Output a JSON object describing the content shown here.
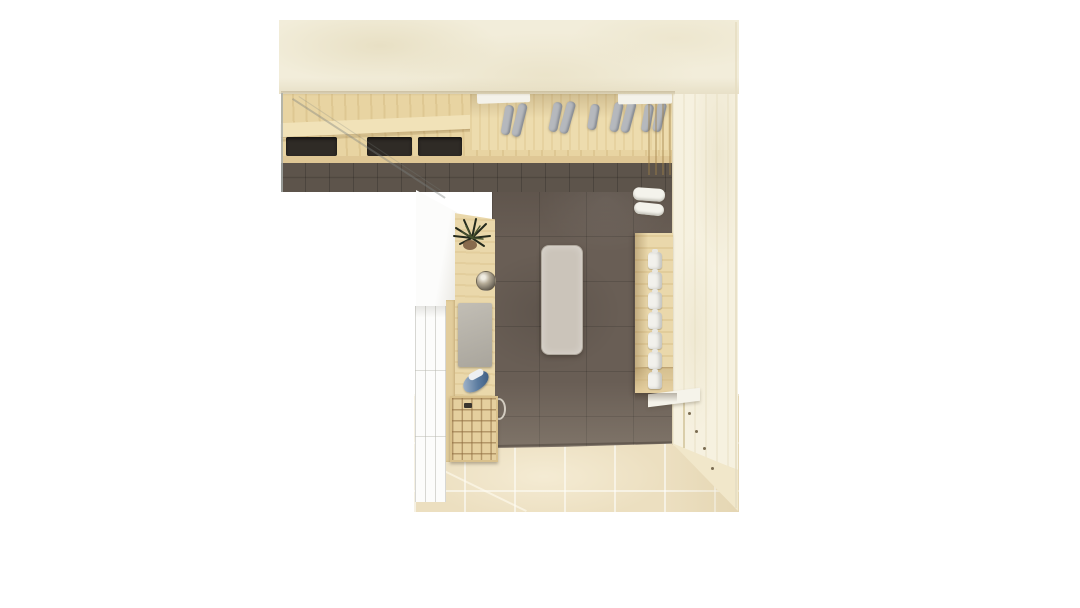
{
  "meta": {
    "description": "Photorealistic top-down 3D render of an L-shaped laundry / utility room on a white background",
    "view": "top-down",
    "visible_text": "none"
  },
  "palette": {
    "background": "#ffffff",
    "wallTop": "#f2edda",
    "wallRight": "#f6f1e0",
    "woodLight": "#e8d4a2",
    "woodMid": "#dfc795",
    "unitWood": "#ead8ab",
    "cubbyWood": "#e5cf9e",
    "tileDark": "#695e55",
    "brick": "#5d544b",
    "floorPale": "#ecdfc0",
    "cabinetWhite": "#fcfcfb",
    "rugGrey": "#cbc4ba",
    "panelGrey": "#b6b2a9",
    "ironBlue": "#5c7ca0",
    "bottleWhite": "#f2f1ec",
    "hangerGrey": "#b5b8bd",
    "slotDark": "#2f2b26"
  },
  "scene": {
    "objects": [
      "top-wall",
      "right-wall",
      "laundry-counter",
      "appliance-slots",
      "garment-rail-with-hangers",
      "dark-tile-floor",
      "pale-wood-floor",
      "floor-rug",
      "white-cabinet",
      "wardrobe-doors",
      "tall-shelf-unit",
      "potted-plant",
      "metal-bowl",
      "grey-board",
      "clothes-iron",
      "cubby-shelf",
      "wall-cabinet-with-bottles",
      "folded-towels",
      "cable-hoop",
      "glass-partition-edge"
    ],
    "counter_slots": [
      {
        "x": 286,
        "w": 51
      },
      {
        "x": 367,
        "w": 45
      },
      {
        "x": 418,
        "w": 44
      }
    ],
    "hangers": [
      {
        "x": 503,
        "t": 105,
        "h": 30,
        "r": 10
      },
      {
        "x": 515,
        "t": 103,
        "h": 34,
        "r": 14
      },
      {
        "x": 551,
        "t": 102,
        "h": 30,
        "r": 12
      },
      {
        "x": 563,
        "t": 101,
        "h": 33,
        "r": 16
      },
      {
        "x": 589,
        "t": 104,
        "h": 26,
        "r": 10
      },
      {
        "x": 612,
        "t": 102,
        "h": 30,
        "r": 12
      },
      {
        "x": 624,
        "t": 101,
        "h": 32,
        "r": 15
      },
      {
        "x": 643,
        "t": 104,
        "h": 28,
        "r": 10
      },
      {
        "x": 655,
        "t": 102,
        "h": 30,
        "r": 13
      }
    ],
    "shelf_bottles": [
      {
        "y": 252
      },
      {
        "y": 272
      },
      {
        "y": 292
      },
      {
        "y": 312
      },
      {
        "y": 332
      },
      {
        "y": 352
      },
      {
        "y": 372
      }
    ],
    "towels": [
      {
        "x": 633,
        "y": 188,
        "w": 32,
        "h": 13,
        "r": 4
      },
      {
        "x": 634,
        "y": 203,
        "w": 30,
        "h": 12,
        "r": 6
      }
    ],
    "screw_dots": [
      {
        "x": 688,
        "y": 412
      },
      {
        "x": 695,
        "y": 430
      },
      {
        "x": 703,
        "y": 447
      },
      {
        "x": 711,
        "y": 467
      }
    ]
  }
}
